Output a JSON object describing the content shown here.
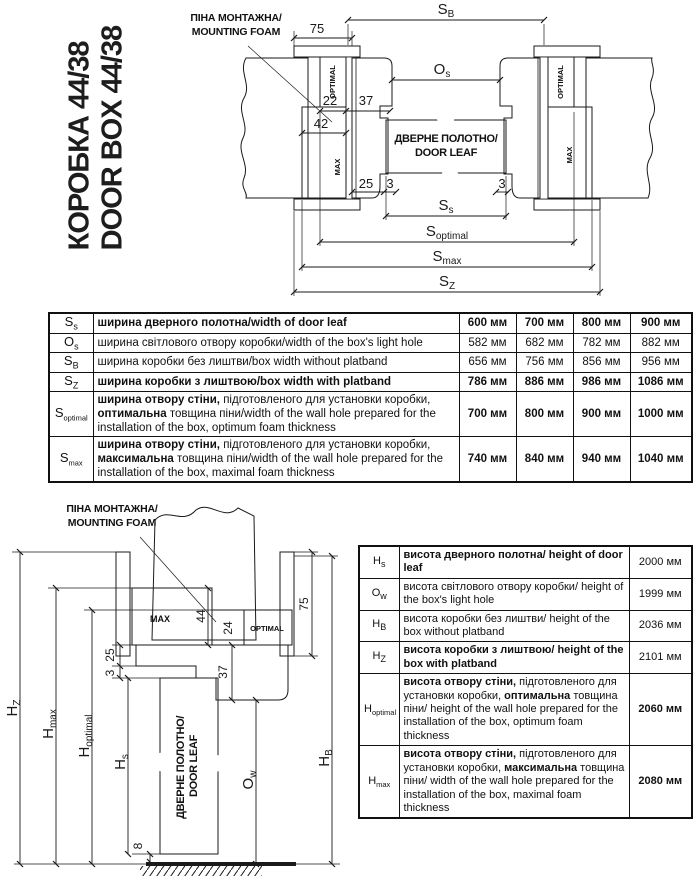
{
  "title": {
    "line1": "КОРОБКА 44/38",
    "line2": "DOOR BOX 44/38"
  },
  "foam_label": {
    "line1": "ПІНА МОНТАЖНА/",
    "line2": "MOUNTING FOAM"
  },
  "door_leaf_label": {
    "line1": "ДВЕРНЕ ПОЛОТНО/",
    "line2": "DOOR LEAF"
  },
  "foam_blocks": {
    "optimal": "OPTIMAL",
    "max": "MAX"
  },
  "dims_top": {
    "sb": "S",
    "sb_sub": "B",
    "n75": "75",
    "os": "O",
    "os_sub": "s",
    "n22": "22",
    "n37": "37",
    "n42": "42",
    "n25": "25",
    "n3_left": "3",
    "n3_right": "3",
    "ss": "S",
    "ss_sub": "s",
    "sopt": "S",
    "sopt_sub": "optimal",
    "smax": "S",
    "smax_sub": "max",
    "sz": "S",
    "sz_sub": "Z"
  },
  "dims_bottom": {
    "n75": "75",
    "n44": "44",
    "n24": "24",
    "n37": "37",
    "n25": "25",
    "n3": "3",
    "n8": "8",
    "hz": "H",
    "hz_sub": "Z",
    "hmax": "H",
    "hmax_sub": "max",
    "hopt": "H",
    "hopt_sub": "optimal",
    "hs": "H",
    "hs_sub": "s",
    "ow": "O",
    "ow_sub": "w",
    "hb": "H",
    "hb_sub": "B"
  },
  "width_table": {
    "rows": [
      {
        "sym": "S",
        "sub": "s",
        "desc": [
          {
            "t": "ширина дверного полотна/width of door leaf",
            "b": true
          }
        ],
        "values": [
          "600 мм",
          "700 мм",
          "800 мм",
          "900 мм"
        ],
        "bold_values": true
      },
      {
        "sym": "O",
        "sub": "s",
        "desc": [
          {
            "t": "ширина світлового отвору коробки/width of the box's light hole",
            "b": false
          }
        ],
        "values": [
          "582 мм",
          "682 мм",
          "782 мм",
          "882 мм"
        ],
        "bold_values": false
      },
      {
        "sym": "S",
        "sub": "B",
        "desc": [
          {
            "t": "ширина коробки без лиштви/box width without platband",
            "b": false
          }
        ],
        "values": [
          "656 мм",
          "756 мм",
          "856 мм",
          "956 мм"
        ],
        "bold_values": false
      },
      {
        "sym": "S",
        "sub": "Z",
        "desc": [
          {
            "t": "ширина коробки з лиштвою/box width with platband",
            "b": true
          }
        ],
        "values": [
          "786 мм",
          "886 мм",
          "986 мм",
          "1086 мм"
        ],
        "bold_values": true
      },
      {
        "sym": "S",
        "sub": "optimal",
        "desc": [
          {
            "t": "ширина отвору стіни,",
            "b": true
          },
          {
            "t": " підготовленого для установки коробки, ",
            "b": false
          },
          {
            "t": "оптимальна",
            "b": true
          },
          {
            "t": " товщина піни/width of the wall hole prepared for the installation of the box, optimum foam thickness",
            "b": false
          }
        ],
        "values": [
          "700 мм",
          "800 мм",
          "900 мм",
          "1000 мм"
        ],
        "bold_values": true
      },
      {
        "sym": "S",
        "sub": "max",
        "desc": [
          {
            "t": "ширина отвору стіни,",
            "b": true
          },
          {
            "t": " підготовленого для установки коробки, ",
            "b": false
          },
          {
            "t": "максимальна",
            "b": true
          },
          {
            "t": " товщина піни/width of the wall hole prepared for the installation of the box, maximal foam thickness",
            "b": false
          }
        ],
        "values": [
          "740 мм",
          "840 мм",
          "940 мм",
          "1040 мм"
        ],
        "bold_values": true
      }
    ]
  },
  "height_table": {
    "rows": [
      {
        "sym": "H",
        "sub": "s",
        "desc": [
          {
            "t": "висота дверного полотна/ height of door leaf",
            "b": true
          }
        ],
        "value": "2000 мм",
        "bold_value": false
      },
      {
        "sym": "O",
        "sub": "w",
        "desc": [
          {
            "t": "висота світлового отвору коробки/ height of the box's light hole",
            "b": false
          }
        ],
        "value": "1999 мм",
        "bold_value": false
      },
      {
        "sym": "H",
        "sub": "B",
        "desc": [
          {
            "t": "висота коробки без лиштви/ height of the box without platband",
            "b": false
          }
        ],
        "value": "2036 мм",
        "bold_value": false
      },
      {
        "sym": "H",
        "sub": "Z",
        "desc": [
          {
            "t": "висота коробки з лиштвою/ height of the box with platband",
            "b": true
          }
        ],
        "value": "2101 мм",
        "bold_value": false
      },
      {
        "sym": "H",
        "sub": "optimal",
        "desc": [
          {
            "t": "висота отвору стіни,",
            "b": true
          },
          {
            "t": " підготовленого для установки коробки, ",
            "b": false
          },
          {
            "t": "оптимальна",
            "b": true
          },
          {
            "t": " товщина піни/ height of the wall hole prepared for the installation of the box, optimum foam thickness",
            "b": false
          }
        ],
        "value": "2060 мм",
        "bold_value": true
      },
      {
        "sym": "H",
        "sub": "max",
        "desc": [
          {
            "t": "висота отвору стіни,",
            "b": true
          },
          {
            "t": " підготовленого для установки коробки, ",
            "b": false
          },
          {
            "t": "максимальна",
            "b": true
          },
          {
            "t": " товщина піни/ width of the wall hole prepared for the installation of the box, maximal foam thickness",
            "b": false
          }
        ],
        "value": "2080 мм",
        "bold_value": true
      }
    ]
  },
  "colors": {
    "foam_yellow": "#ffd203",
    "brick_red": "#ad4527",
    "mortar": "#d7c7a9",
    "wood_tan": "#d9ba83",
    "frame_peach": "#f4cfa5",
    "line_black": "#1a1a1a"
  }
}
